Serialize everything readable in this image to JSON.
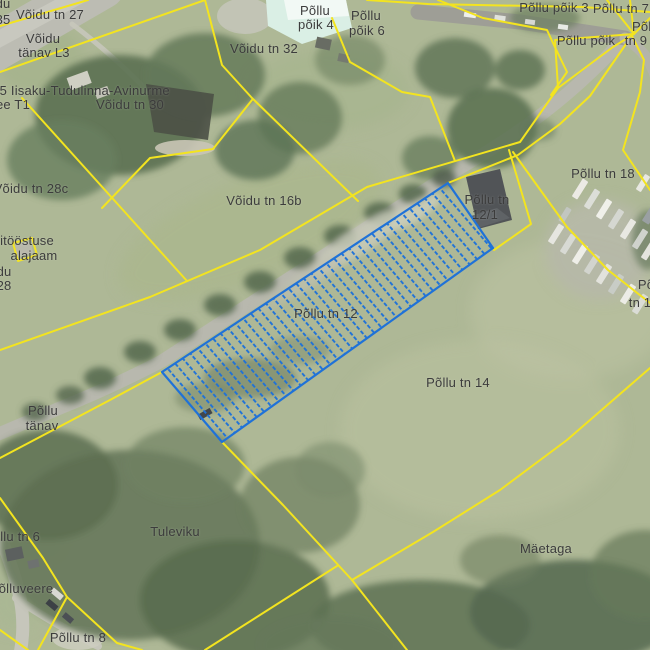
{
  "app": {
    "type": "cadastral-map-viewer",
    "view": "aerial-photo-with-cadastral-overlay"
  },
  "map": {
    "colors": {
      "cadastral_boundary": "#f3e41f",
      "selected_parcel": "#1f72d8",
      "label_text": "#3c3c3c"
    },
    "selected_parcel": {
      "label": "Põllu tn 12"
    },
    "labels": [
      {
        "text": "du",
        "x": 3,
        "y": 4
      },
      {
        "text": "35",
        "x": 3,
        "y": 20
      },
      {
        "text": "Võidu tn 27",
        "x": 50,
        "y": 15
      },
      {
        "text": "Võidu",
        "x": 43,
        "y": 39
      },
      {
        "text": "tänav L3",
        "x": 44,
        "y": 53
      },
      {
        "text": "35 Iisaku-Tudulinna-Avinurme",
        "x": 81,
        "y": 91
      },
      {
        "text": "ee T1",
        "x": 13,
        "y": 105
      },
      {
        "text": "Võidu tn 30",
        "x": 130,
        "y": 105
      },
      {
        "text": "Põllu",
        "x": 315,
        "y": 11
      },
      {
        "text": "põik 4",
        "x": 316,
        "y": 25
      },
      {
        "text": "Põllu",
        "x": 366,
        "y": 16
      },
      {
        "text": "põik 6",
        "x": 367,
        "y": 31
      },
      {
        "text": "Võidu tn 32",
        "x": 264,
        "y": 49
      },
      {
        "text": "Põllu põik 3",
        "x": 554,
        "y": 8
      },
      {
        "text": "Põllu tn 7",
        "x": 621,
        "y": 9
      },
      {
        "text": "Põllu",
        "x": 647,
        "y": 27
      },
      {
        "text": "Põllu põik",
        "x": 586,
        "y": 41
      },
      {
        "text": "tn 9",
        "x": 636,
        "y": 41
      },
      {
        "text": "Võidu tn 28c",
        "x": 31,
        "y": 189
      },
      {
        "text": "itööstuse",
        "x": 27,
        "y": 241
      },
      {
        "text": "alajaam",
        "x": 34,
        "y": 256
      },
      {
        "text": "du",
        "x": 4,
        "y": 272
      },
      {
        "text": "28",
        "x": 4,
        "y": 286
      },
      {
        "text": "Võidu tn 16b",
        "x": 264,
        "y": 201
      },
      {
        "text": "Põllu tn 18",
        "x": 603,
        "y": 174
      },
      {
        "text": "Põllu tn",
        "x": 487,
        "y": 200
      },
      {
        "text": "12/1",
        "x": 485,
        "y": 215
      },
      {
        "text": "Põllu tn 12",
        "x": 326,
        "y": 314
      },
      {
        "text": "Põllu tn 14",
        "x": 458,
        "y": 383
      },
      {
        "text": "Põ",
        "x": 646,
        "y": 285
      },
      {
        "text": "tn 1",
        "x": 640,
        "y": 303
      },
      {
        "text": "Põllu",
        "x": 43,
        "y": 411
      },
      {
        "text": "tänav",
        "x": 42,
        "y": 426
      },
      {
        "text": "Tuleviku",
        "x": 175,
        "y": 532
      },
      {
        "text": "Mäetaga",
        "x": 546,
        "y": 549
      },
      {
        "text": "Põllu tn 6",
        "x": 12,
        "y": 537
      },
      {
        "text": "õlluveere",
        "x": 26,
        "y": 589
      },
      {
        "text": "Põllu tn 8",
        "x": 78,
        "y": 638
      }
    ]
  }
}
